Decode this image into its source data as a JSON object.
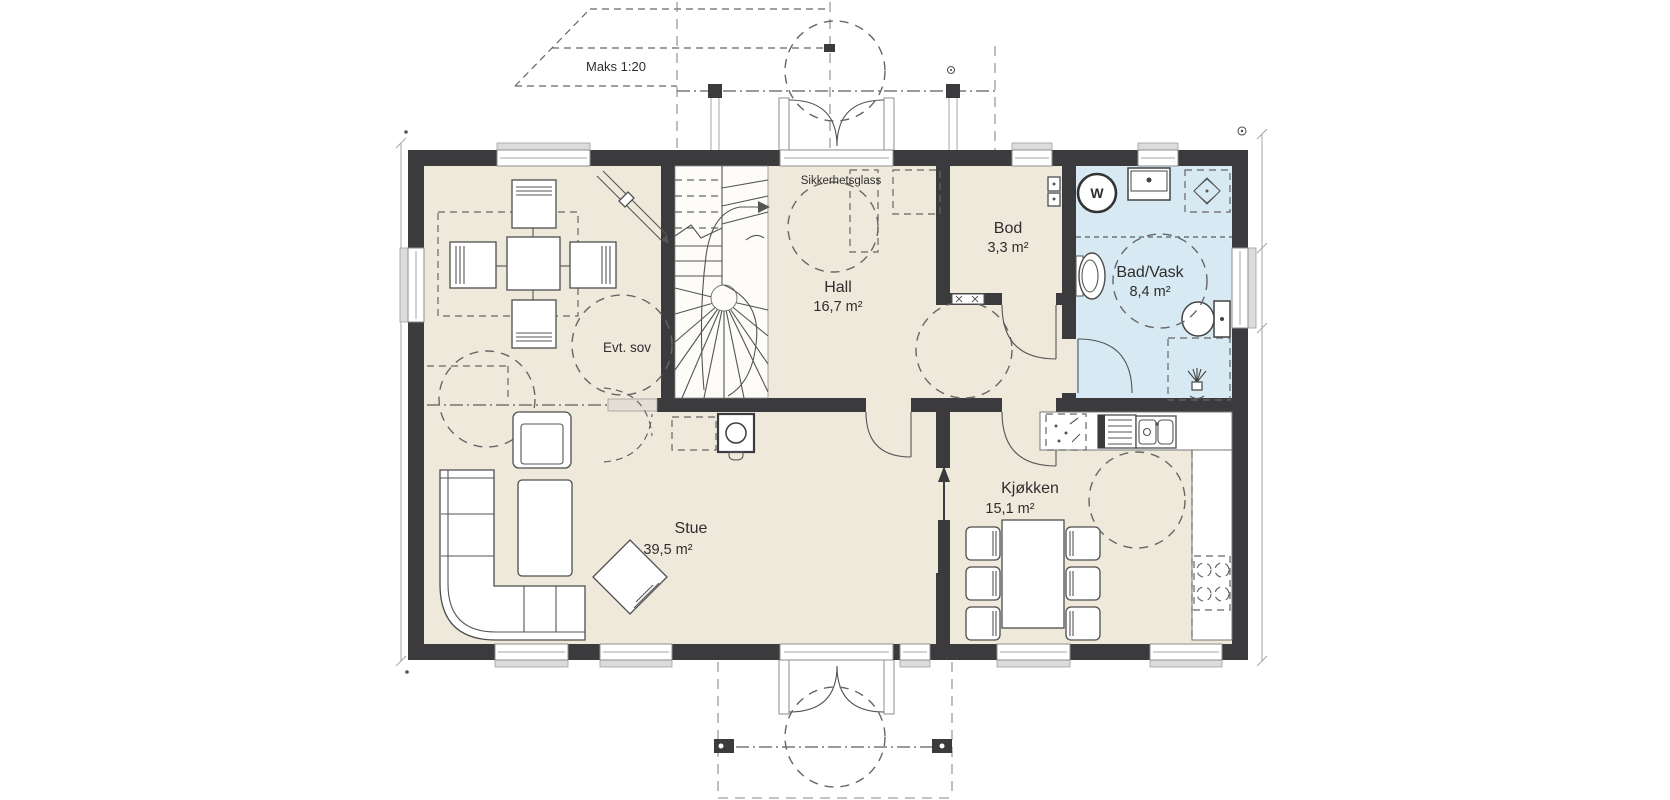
{
  "plan": {
    "annotations": {
      "ramp_label": "Maks 1:20",
      "entry_glass_label": "Sikkerhetsglass"
    },
    "fixtures": {
      "washing_machine_symbol": "W"
    },
    "rooms": {
      "evt_sov": {
        "name": "Evt. sov"
      },
      "hall": {
        "name": "Hall",
        "area": "16,7 m²"
      },
      "bod": {
        "name": "Bod",
        "area": "3,3 m²"
      },
      "bad_vask": {
        "name": "Bad/Vask",
        "area": "8,4 m²"
      },
      "stue": {
        "name": "Stue",
        "area": "39,5 m²"
      },
      "kjokken": {
        "name": "Kjøkken",
        "area": "15,1 m²"
      }
    },
    "colors": {
      "wall": "#3b3b3d",
      "floor": "#efe9dc",
      "bathroom_floor": "#d7e9f2",
      "background": "#ffffff",
      "line": "#4f4f4f"
    }
  }
}
